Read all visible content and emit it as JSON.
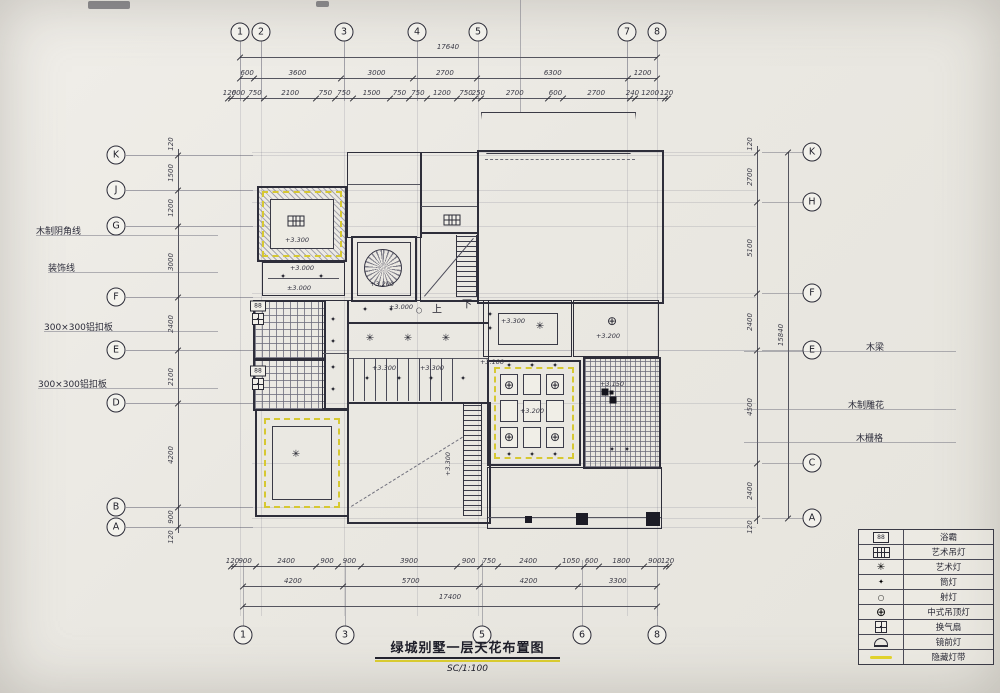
{
  "title_block": {
    "title": "绿城别墅一层天花布置图",
    "scale": "SC/1:100"
  },
  "axes": {
    "top_bubbles": [
      {
        "l": "1",
        "x": 240
      },
      {
        "l": "2",
        "x": 261
      },
      {
        "l": "3",
        "x": 344
      },
      {
        "l": "4",
        "x": 417
      },
      {
        "l": "5",
        "x": 478
      },
      {
        "l": "7",
        "x": 627
      },
      {
        "l": "8",
        "x": 657
      }
    ],
    "bottom_bubbles": [
      {
        "l": "1",
        "x": 243
      },
      {
        "l": "3",
        "x": 345
      },
      {
        "l": "5",
        "x": 482
      },
      {
        "l": "6",
        "x": 582
      },
      {
        "l": "8",
        "x": 657
      }
    ],
    "left_bubbles": [
      {
        "l": "K",
        "y": 155
      },
      {
        "l": "J",
        "y": 190
      },
      {
        "l": "G",
        "y": 226
      },
      {
        "l": "F",
        "y": 297
      },
      {
        "l": "E",
        "y": 350
      },
      {
        "l": "D",
        "y": 403
      },
      {
        "l": "B",
        "y": 507
      },
      {
        "l": "A",
        "y": 527
      }
    ],
    "right_bubbles": [
      {
        "l": "K",
        "y": 152
      },
      {
        "l": "H",
        "y": 202
      },
      {
        "l": "F",
        "y": 293
      },
      {
        "l": "E",
        "y": 350
      },
      {
        "l": "C",
        "y": 463
      },
      {
        "l": "A",
        "y": 518
      }
    ]
  },
  "dims": {
    "top_total": "17640",
    "top_rows": [
      [
        "600",
        "3600",
        "3000",
        "2700",
        "6300",
        "1200"
      ],
      [
        "120",
        "600",
        "750",
        "2100",
        "750",
        "750",
        "1500",
        "750",
        "750",
        "1200",
        "750",
        "250",
        "2700",
        "600",
        "2700",
        "240",
        "1200",
        "120"
      ]
    ],
    "bottom_rows": [
      [
        "120",
        "900",
        "2400",
        "900",
        "900",
        "3900",
        "900",
        "750",
        "2400",
        "1050",
        "600",
        "1800",
        "900",
        "120"
      ],
      [
        "4200",
        "5700",
        "4200",
        "3300"
      ]
    ],
    "bottom_total": "17400",
    "left_col": [
      "1500",
      "1200",
      "3000",
      "2400",
      "2100",
      "4200",
      "900"
    ],
    "left_edges": [
      "120",
      "120"
    ],
    "right_col": [
      "2700",
      "5100",
      "2400",
      "4500",
      "2400"
    ],
    "right_edges": [
      "120",
      "120"
    ],
    "right_total": "15840"
  },
  "annotations": {
    "left": [
      {
        "text": "木制阴角线",
        "x": 36,
        "y": 224
      },
      {
        "text": "装饰线",
        "x": 48,
        "y": 261
      },
      {
        "text": "300×300铝扣板",
        "x": 44,
        "y": 320
      },
      {
        "text": "300×300铝扣板",
        "x": 38,
        "y": 377
      }
    ],
    "right": [
      {
        "text": "木梁",
        "x": 866,
        "y": 340
      },
      {
        "text": "木制雕花",
        "x": 848,
        "y": 398
      },
      {
        "text": "木栅格",
        "x": 856,
        "y": 431
      }
    ]
  },
  "plan_labels": {
    "stair_up": "上",
    "stair_down": "下",
    "elevations": [
      {
        "t": "+3.300",
        "x": 297,
        "y": 240
      },
      {
        "t": "+3.000",
        "x": 302,
        "y": 268
      },
      {
        "t": "±3.000",
        "x": 299,
        "y": 288
      },
      {
        "t": "+3.200",
        "x": 382,
        "y": 284
      },
      {
        "t": "+3.000",
        "x": 401,
        "y": 307
      },
      {
        "t": "+3.300",
        "x": 384,
        "y": 368
      },
      {
        "t": "+3.300",
        "x": 432,
        "y": 368
      },
      {
        "t": "+3.300",
        "x": 513,
        "y": 321
      },
      {
        "t": "+3.200",
        "x": 608,
        "y": 336
      },
      {
        "t": "+3.100",
        "x": 492,
        "y": 362
      },
      {
        "t": "+3.200",
        "x": 532,
        "y": 411
      },
      {
        "t": "+3.150",
        "x": 612,
        "y": 384
      },
      {
        "t": "+3.300",
        "x": 448,
        "y": 464,
        "rot": 1
      }
    ]
  },
  "symbols": [
    {
      "type": "art-pendant",
      "x": 296,
      "y": 221
    },
    {
      "type": "art-pendant",
      "x": 452,
      "y": 220
    },
    {
      "type": "art-lamp",
      "x": 296,
      "y": 455
    },
    {
      "type": "art-lamp",
      "x": 540,
      "y": 327
    },
    {
      "type": "art-lamp",
      "x": 370,
      "y": 339
    },
    {
      "type": "art-lamp",
      "x": 408,
      "y": 339
    },
    {
      "type": "art-lamp",
      "x": 446,
      "y": 339
    },
    {
      "type": "downlight",
      "x": 333,
      "y": 320
    },
    {
      "type": "downlight",
      "x": 333,
      "y": 342
    },
    {
      "type": "downlight",
      "x": 333,
      "y": 368
    },
    {
      "type": "downlight",
      "x": 333,
      "y": 390
    },
    {
      "type": "downlight",
      "x": 365,
      "y": 310
    },
    {
      "type": "downlight",
      "x": 391,
      "y": 310
    },
    {
      "type": "downlight",
      "x": 283,
      "y": 277
    },
    {
      "type": "downlight",
      "x": 321,
      "y": 277
    },
    {
      "type": "downlight",
      "x": 367,
      "y": 379
    },
    {
      "type": "downlight",
      "x": 399,
      "y": 379
    },
    {
      "type": "downlight",
      "x": 431,
      "y": 379
    },
    {
      "type": "downlight",
      "x": 463,
      "y": 379
    },
    {
      "type": "downlight",
      "x": 509,
      "y": 366
    },
    {
      "type": "downlight",
      "x": 532,
      "y": 366
    },
    {
      "type": "downlight",
      "x": 555,
      "y": 366
    },
    {
      "type": "downlight",
      "x": 509,
      "y": 455
    },
    {
      "type": "downlight",
      "x": 532,
      "y": 455
    },
    {
      "type": "downlight",
      "x": 555,
      "y": 455
    },
    {
      "type": "downlight",
      "x": 490,
      "y": 315
    },
    {
      "type": "downlight",
      "x": 490,
      "y": 329
    },
    {
      "type": "downlight",
      "x": 612,
      "y": 450
    },
    {
      "type": "downlight",
      "x": 627,
      "y": 450
    },
    {
      "type": "spotlight",
      "x": 419,
      "y": 310
    },
    {
      "type": "chinese-lamp",
      "x": 612,
      "y": 321
    },
    {
      "type": "chinese-lamp",
      "x": 509,
      "y": 385
    },
    {
      "type": "chinese-lamp",
      "x": 555,
      "y": 385
    },
    {
      "type": "chinese-lamp",
      "x": 509,
      "y": 437
    },
    {
      "type": "chinese-lamp",
      "x": 555,
      "y": 437
    },
    {
      "type": "bath-heater",
      "x": 258,
      "y": 306
    },
    {
      "type": "bath-heater",
      "x": 258,
      "y": 371
    },
    {
      "type": "exhaust-fan",
      "x": 258,
      "y": 319
    },
    {
      "type": "exhaust-fan",
      "x": 258,
      "y": 384
    },
    {
      "type": "cross-dark",
      "x": 609,
      "y": 396
    }
  ],
  "legend": {
    "rows": [
      {
        "sym": "bath-heater",
        "label": "浴霸"
      },
      {
        "sym": "art-pendant",
        "label": "艺术吊灯"
      },
      {
        "sym": "art-lamp",
        "label": "艺术灯"
      },
      {
        "sym": "downlight",
        "label": "筒灯"
      },
      {
        "sym": "spotlight",
        "label": "射灯"
      },
      {
        "sym": "chinese-lamp",
        "label": "中式吊顶灯"
      },
      {
        "sym": "exhaust-fan",
        "label": "换气扇"
      },
      {
        "sym": "mirror-light",
        "label": "镜前灯"
      },
      {
        "sym": "light-strip",
        "label": "隐藏灯带"
      }
    ]
  }
}
